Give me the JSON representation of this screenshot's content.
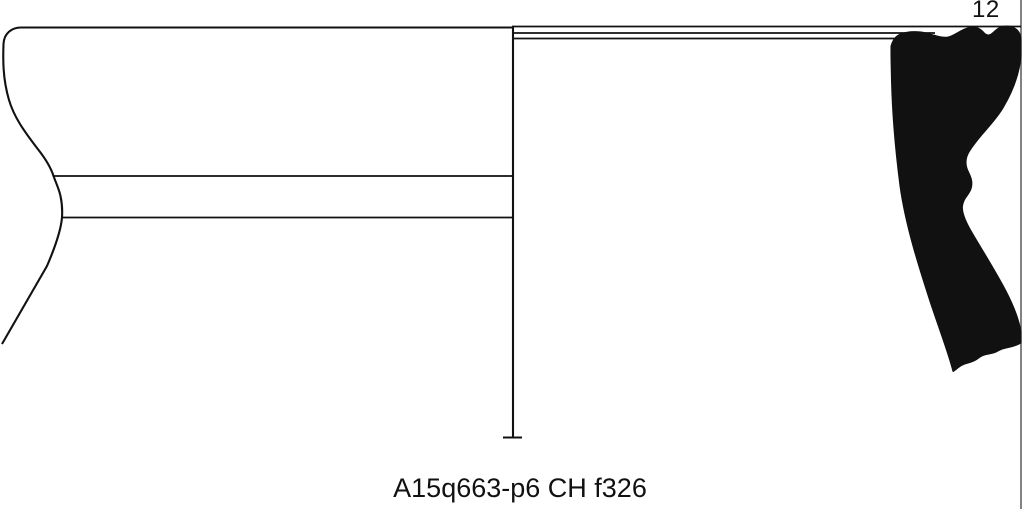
{
  "figure": {
    "plate_number": "12",
    "caption": "A15q663-p6 CH f326",
    "ink_color": "#111111",
    "border_color": "#4d4d4d",
    "background_color": "#ffffff"
  },
  "drawing": {
    "description": "pottery-rim-sherd-profile",
    "exterior_outline": "M512 27.5 L21 27.5 C12 27.5 4 33 3.5 44 C3 58 2.5 78 9 100 C14 117 24 131 37 148 C45 158 51 168 53.5 176 C56 183 59 189 60.5 196 C62 203 62.5 210 62 217.5 C61 230 56 245 47 266 L2 344",
    "band_line_upper": "M53 176 L512 176",
    "band_line_lower": "M62 217.5 L512 217.5",
    "center_axis": "M513 27 L513 437",
    "axis_foot_tick": "M503 437.5 L522 437.5",
    "rim_line_top": "M512 26.5 L1021 26.5",
    "rim_line_mid": "M513.5 33 L935 33",
    "rim_line_low": "M513.5 38.5 L931 38.5",
    "plate_border": "M1021 0 L1021 509",
    "section_profile": "M891 46 C893 39 896 35.5 901 33.8 C909 31 919 31 927 33.2 C935 35.2 941 38 947 37.2 C955 36.2 961 28.5 970.5 27.2 C977.5 26.2 981.5 30 984.5 33.2 C987.5 36.3 990.5 35.2 994.5 31.2 C998.5 27.2 1003.5 25.2 1009.5 26.2 C1016 27.3 1021 32 1021 40 L1021 56 C1019.5 74 1012.5 92 1003 108 C993.5 124 978.5 136 969 152 C964.5 159.5 965.5 166 968.5 172 C971.5 178 973 183 971 189 C969 195 963.5 198 962.5 206 C961.8 212 965 220 970 229 C979 245 994 268 1006 291 C1013 304.5 1019 319 1021 332 L1021 343 C1012 348.5 1005 346.5 998 351 C991 355.5 985 352.5 978 358.5 C971.5 364 964.5 362 958.5 367.5 C955.5 370 953.5 371.5 953 371.5 C948.5 353.5 940.5 333 930.5 303 C919.5 269 905.5 226 900 186 C896.5 159 892.5 121 891.5 81 C891.2 67 890.8 55 891 46 Z"
  }
}
